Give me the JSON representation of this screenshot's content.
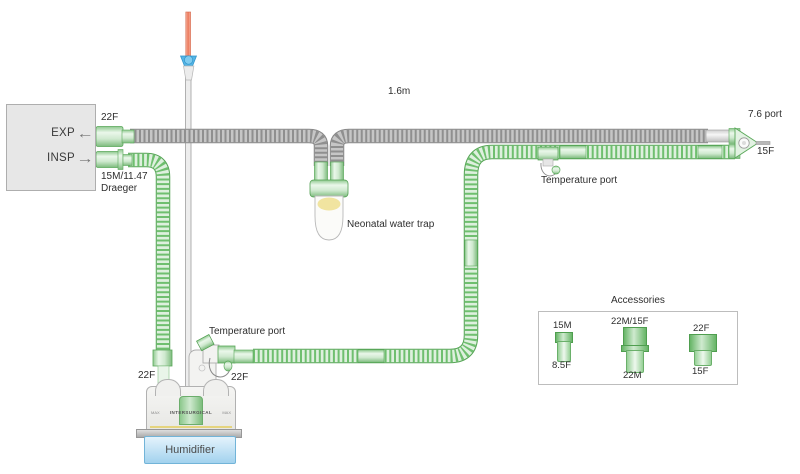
{
  "ventilator": {
    "exp": "EXP",
    "insp": "INSP",
    "exp_port": "22F",
    "insp_port_line1": "15M/11.47",
    "insp_port_line2": "Draeger"
  },
  "circuit": {
    "length": "1.6m",
    "water_trap": "Neonatal water trap",
    "temp_port_limb": "Temperature port",
    "temp_port_humidifier": "Temperature port",
    "patient_port": "7.6 port",
    "patient_connector": "15F",
    "humidifier_inlet": "22F",
    "humidifier_outlet": "22F"
  },
  "humidifier": {
    "label": "Humidifier",
    "brand": "INTERSURGICAL",
    "max_left": "MAX",
    "max_right": "MAX"
  },
  "accessories": {
    "title": "Accessories",
    "items": [
      {
        "top": "15M",
        "bottom": "8.5F"
      },
      {
        "top": "22M/15F",
        "bottom": "22M"
      },
      {
        "top": "22F",
        "bottom": "15F"
      }
    ]
  },
  "colors": {
    "tube_green": "#6fbf6f",
    "tube_gray": "#9a9a9a",
    "connector_green": "#a9dca9",
    "humidifier_base_blue": "#a2d2ee",
    "spike_orange": "#ec7a5c",
    "clamp_blue": "#55b5e6",
    "fluid_yellow": "#f1e4a0"
  }
}
